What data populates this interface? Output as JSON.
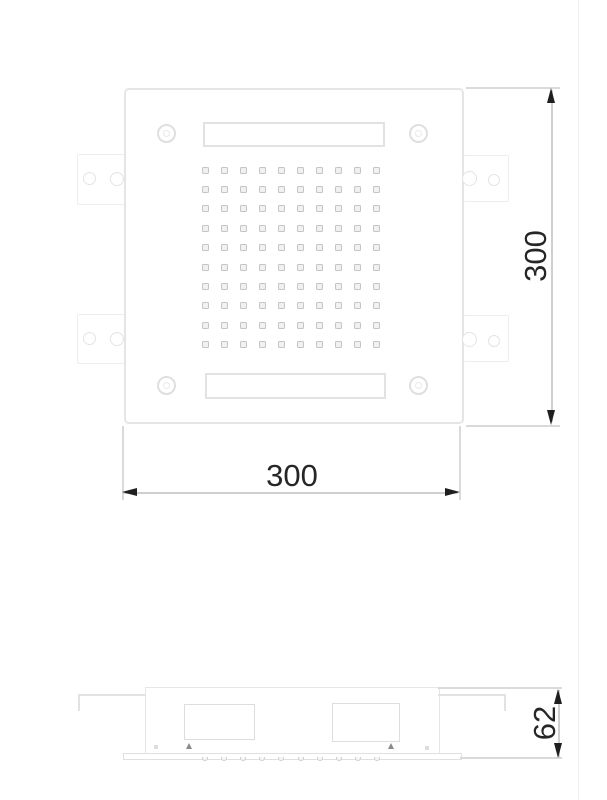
{
  "drawing": {
    "type": "technical-drawing",
    "subject": "square ceiling shower head - plan view and side elevation",
    "dimensions": {
      "plan_height": {
        "value": "300",
        "orientation": "vertical",
        "side": "right"
      },
      "plan_width": {
        "value": "300",
        "orientation": "horizontal",
        "side": "bottom"
      },
      "side_height": {
        "value": "62",
        "orientation": "vertical",
        "side": "right"
      }
    },
    "plan_view": {
      "nozzle_grid": {
        "rows": 10,
        "cols": 10,
        "origin_x": 205,
        "origin_y": 170,
        "spacing_x": 19.1,
        "spacing_y": 19.4,
        "size": 7
      },
      "screw_count": 4,
      "bracket_count": 4,
      "slot_count": 2
    },
    "side_view": {
      "nozzle_ticks": {
        "count": 10,
        "origin_x": 205,
        "spacing_x": 19.1,
        "y": 758
      }
    },
    "colors": {
      "background": "#ffffff",
      "outline": "#e5e5e5",
      "outline_soft": "#ededed",
      "nozzle": "#c5c5c5",
      "dim_line": "#cfcfcf",
      "arrow_and_text": "#1f1f1f"
    }
  }
}
